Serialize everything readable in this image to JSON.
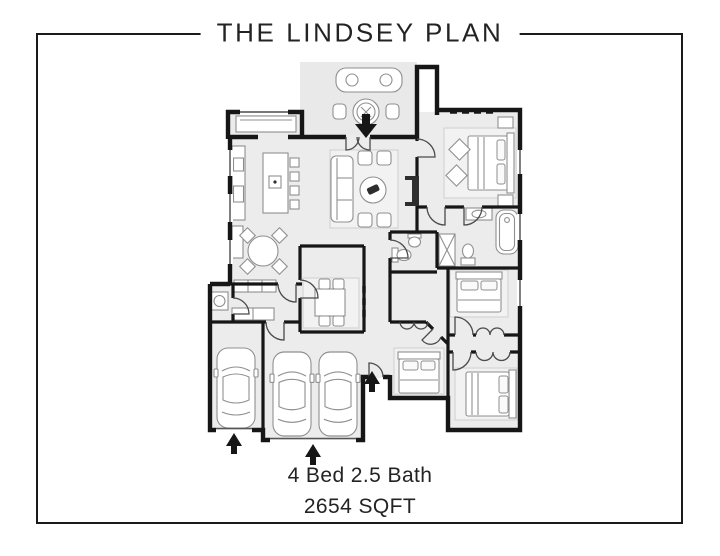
{
  "page": {
    "background": "#ffffff"
  },
  "header": {
    "title": "THE LINDSEY PLAN"
  },
  "footer": {
    "line1": "4 Bed 2.5 Bath",
    "line2": "2654 SQFT"
  },
  "floor_plan": {
    "colors": {
      "frame": "#1a1a1a",
      "text": "#232323",
      "wall": "#161616",
      "room": "#ececec",
      "patio": "#e9e9e9",
      "furn": "#8f8f8f",
      "rug": "#f2f2f2",
      "door": "#4a4a4a",
      "accent": "#2e2e2e"
    },
    "rooms": [
      {
        "name": "patio",
        "furniture": [
          "outdoor-sofa",
          "outdoor-round-table",
          "outdoor-chairs"
        ]
      },
      {
        "name": "great-room",
        "furniture": [
          "window-seat",
          "kitchen-counter",
          "kitchen-island",
          "bar-stools",
          "breakfast-round-table",
          "sofa",
          "round-coffee-table",
          "accent-chairs",
          "fireplace",
          "area-rug"
        ]
      },
      {
        "name": "dining-room",
        "furniture": [
          "table",
          "chairs",
          "area-rug"
        ]
      },
      {
        "name": "master-bedroom",
        "furniture": [
          "bed",
          "nightstands",
          "accent-chairs",
          "area-rug"
        ]
      },
      {
        "name": "master-bathroom",
        "furniture": [
          "bathtub",
          "shower",
          "vanity-sink",
          "toilet"
        ]
      },
      {
        "name": "hall-bathroom",
        "furniture": [
          "toilet",
          "pedestal-sink"
        ]
      },
      {
        "name": "powder-room",
        "furniture": [
          "vanity-sink"
        ]
      },
      {
        "name": "mudroom-laundry",
        "furniture": [
          "cubbies",
          "counter"
        ]
      },
      {
        "name": "bedroom-2",
        "furniture": [
          "bed",
          "closet-bifold-doors"
        ]
      },
      {
        "name": "bedroom-3",
        "furniture": [
          "bed",
          "closet-bifold-doors"
        ]
      },
      {
        "name": "bedroom-4",
        "furniture": [
          "bed",
          "closet-bifold-doors"
        ]
      },
      {
        "name": "garage-single-bay",
        "furniture": [
          "car"
        ]
      },
      {
        "name": "garage-double-bay",
        "furniture": [
          "car",
          "car"
        ]
      }
    ],
    "entry_arrows": [
      "patio-entry-arrow",
      "side-entry-arrow",
      "single-garage-entry-arrow",
      "double-garage-entry-arrow"
    ]
  }
}
